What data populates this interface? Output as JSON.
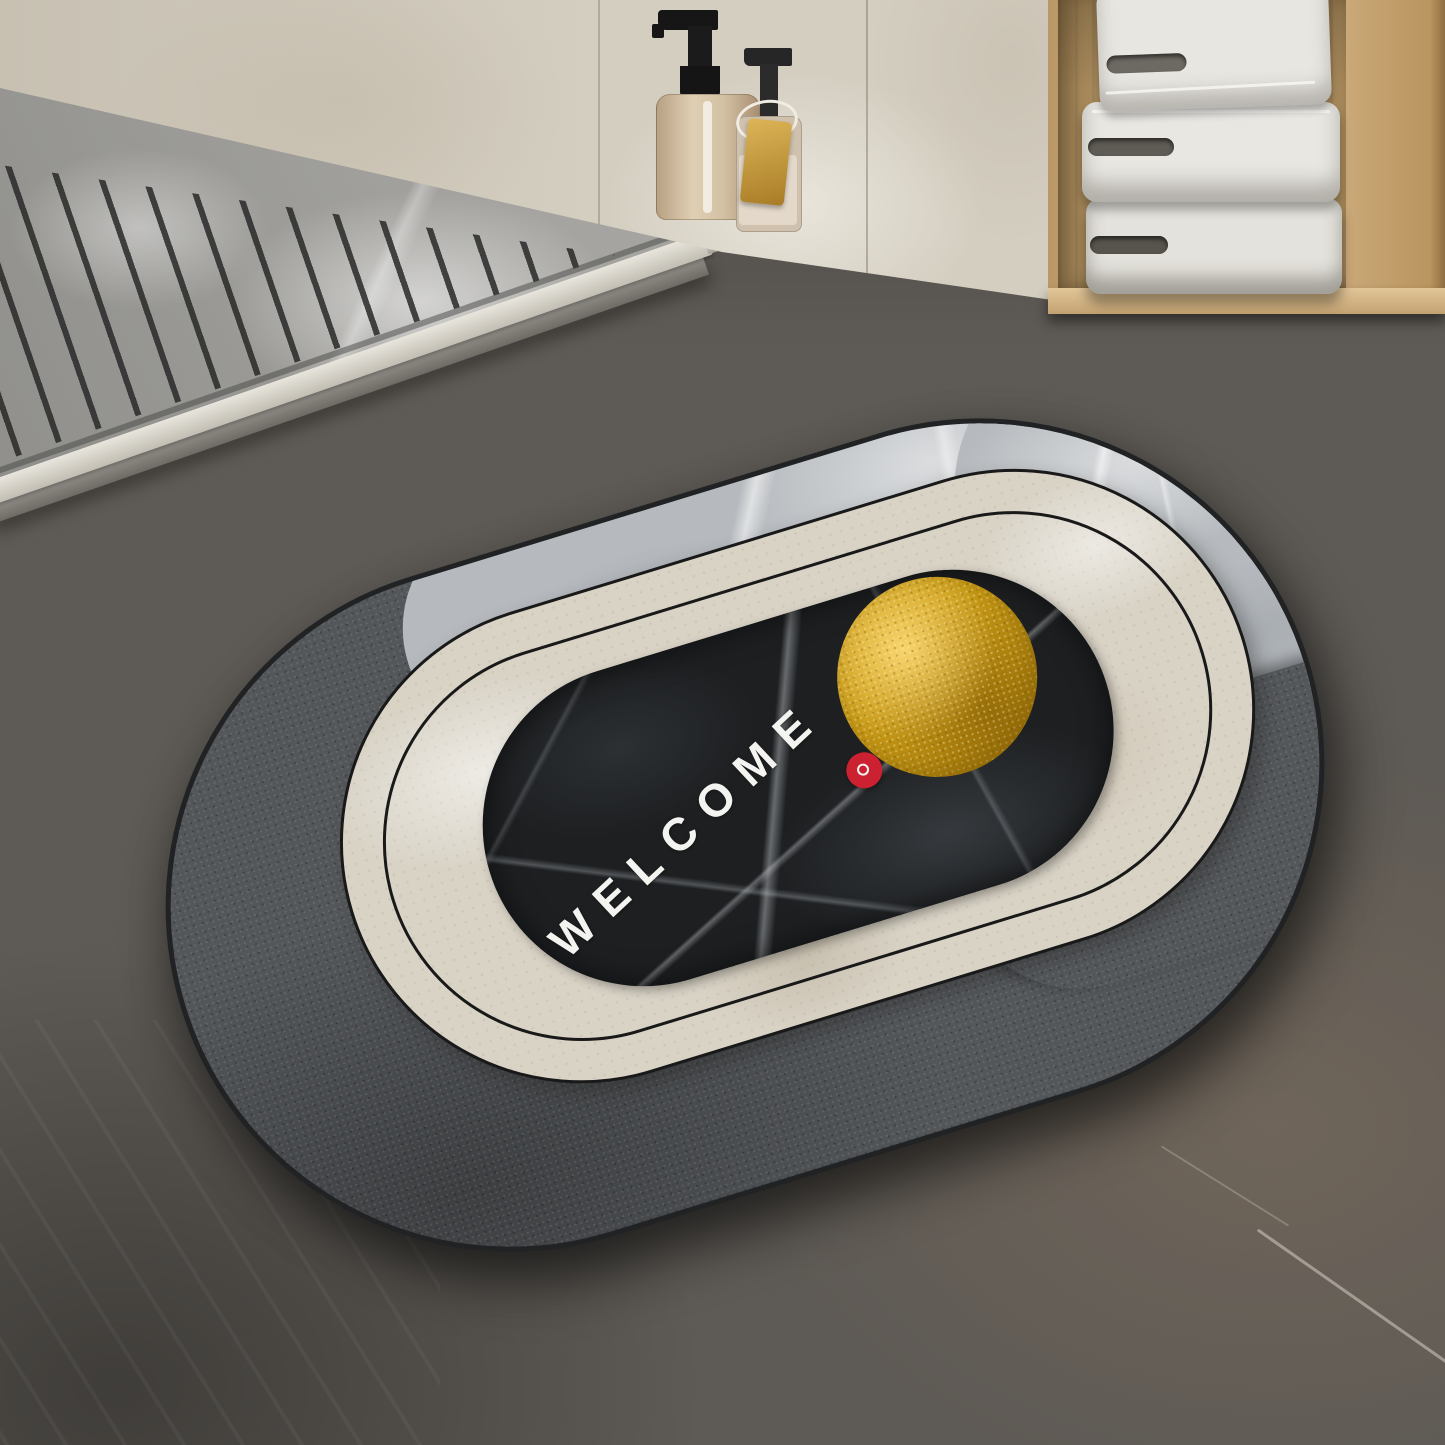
{
  "scene": {
    "description": "Bathroom product photo: oval quick-dry bath mat on dark stone floor beside a marble shower tray, with soap dispensers and a wooden niche holding folded white towels",
    "mat": {
      "welcome_text": "WELCOME",
      "shape": "oval capsule",
      "outer_fabric_color": "#54575a",
      "silver_marble_color": "#b6babe",
      "cream_band_color": "#d9d3c6",
      "black_center_color": "#1d1f21",
      "gold_circle_color": "#c89a15",
      "red_dot_color": "#cc2130",
      "text_color": "#f3f3f0",
      "outline_color": "#191919"
    },
    "shower_tray": {
      "material": "gray marble with drainage grooves",
      "groove_color": "#3c3d3c",
      "curb_color": "#e8e5dc"
    },
    "wall_color": "#d4cec1",
    "floor_color": "#5e5a55",
    "wood_niche": {
      "color": "#c9a876",
      "towel_count": 3,
      "towel_color": "#e8e6e1"
    },
    "soap_dispensers": {
      "count": 2,
      "bottle_a_color": "#d3c1a4",
      "bottle_b_color": "#cfc1ae",
      "pump_color": "#1b1b1b",
      "tag_color": "#ddb558"
    }
  }
}
